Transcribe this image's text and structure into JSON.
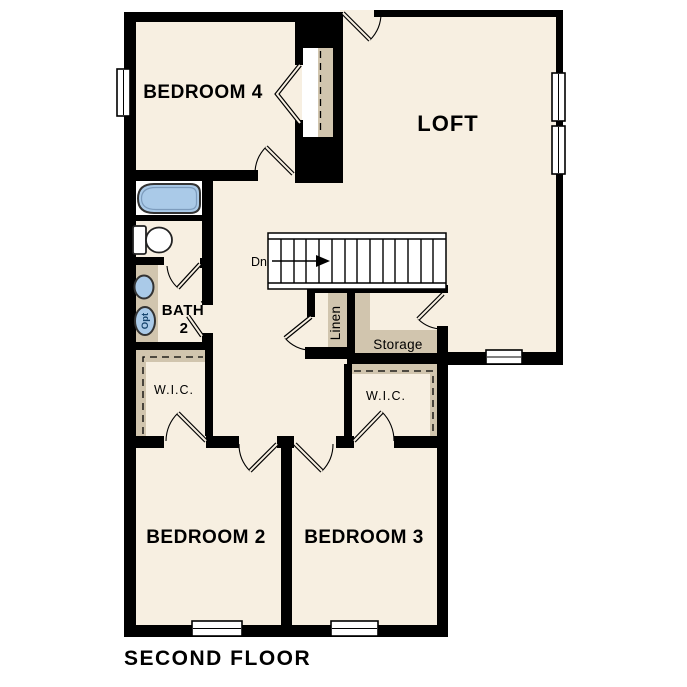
{
  "plan": {
    "title": "SECOND FLOOR",
    "labels": {
      "bedroom4": "BEDROOM 4",
      "loft": "LOFT",
      "bath_line1": "BATH",
      "bath_line2": "2",
      "wic_left": "W.I.C.",
      "wic_right": "W.I.C.",
      "linen": "Linen",
      "storage": "Storage",
      "stairs_direction": "Dn",
      "optional_fixture": "Opt",
      "bedroom2": "BEDROOM 2",
      "bedroom3": "BEDROOM 3"
    },
    "colors": {
      "background": "#ffffff",
      "floor": "#f7efe1",
      "closet_shelf_tan": "#d1c5ae",
      "wall_black": "#000000",
      "fixture_blue": "#aacae8"
    }
  }
}
